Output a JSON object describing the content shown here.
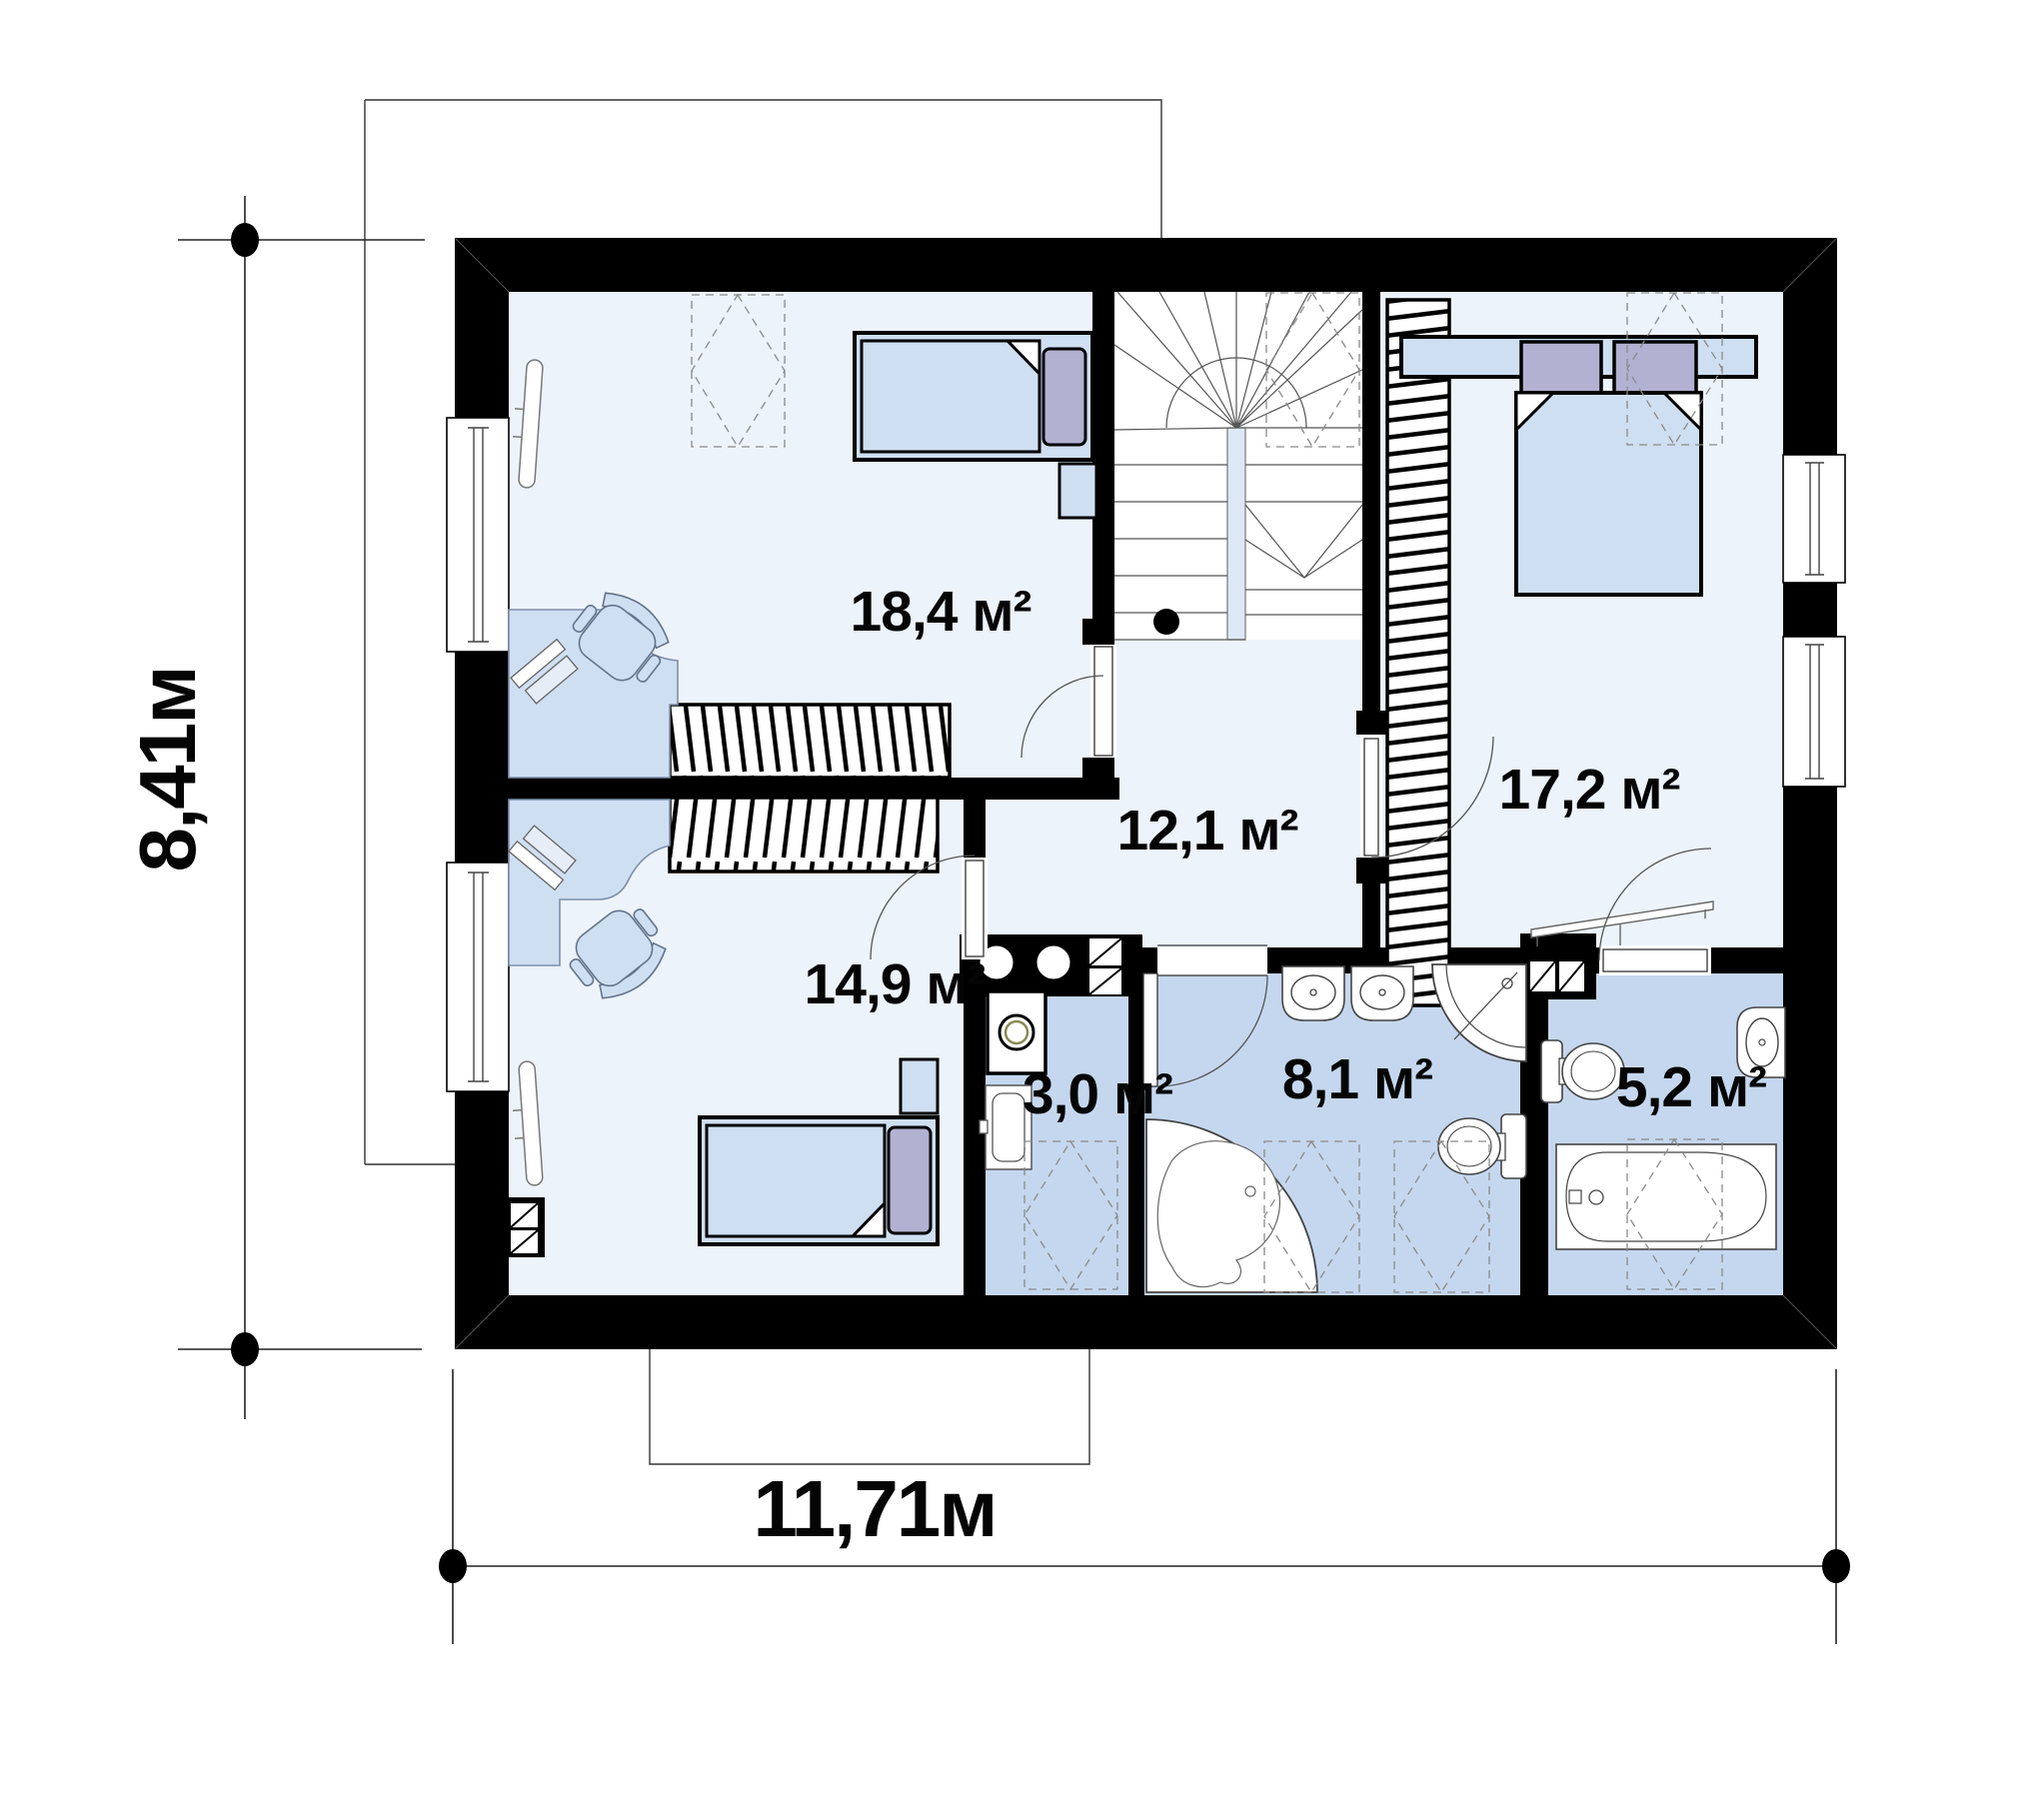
{
  "plan": {
    "title": "second floor plan",
    "rooms": [
      {
        "name": "bedroom-top-left",
        "area_label": "18,4 м²"
      },
      {
        "name": "hall-stairs",
        "area_label": "12,1 м²"
      },
      {
        "name": "bedroom-right",
        "area_label": "17,2 м²"
      },
      {
        "name": "bedroom-bottom-left",
        "area_label": "14,9 м²"
      },
      {
        "name": "laundry-wc",
        "area_label": "3,0 м²"
      },
      {
        "name": "bathroom-main",
        "area_label": "8,1 м²"
      },
      {
        "name": "bathroom-small",
        "area_label": "5,2 м²"
      }
    ],
    "dimensions": {
      "width_label": "11,71м",
      "height_label": "8,41м"
    },
    "colors": {
      "wall": "#000000",
      "room_floor": "#edf3fb",
      "bath_floor": "#c5d7ee",
      "furniture": "#cfdff2",
      "accent_pillow": "#b2b1d1"
    },
    "icons": [
      "stairs-icon",
      "double-bed-icon",
      "single-bed-icon",
      "wardrobe-icon",
      "desk-icon",
      "office-chair-icon",
      "monitor-icon",
      "radiator-icon",
      "washing-machine-icon",
      "toilet-icon",
      "sink-icon",
      "bathtub-icon",
      "corner-bathtub-icon",
      "shower-icon",
      "door-icon",
      "window-icon",
      "vent-shaft-icon",
      "skylight-icon",
      "dimension-dot-icon"
    ]
  }
}
